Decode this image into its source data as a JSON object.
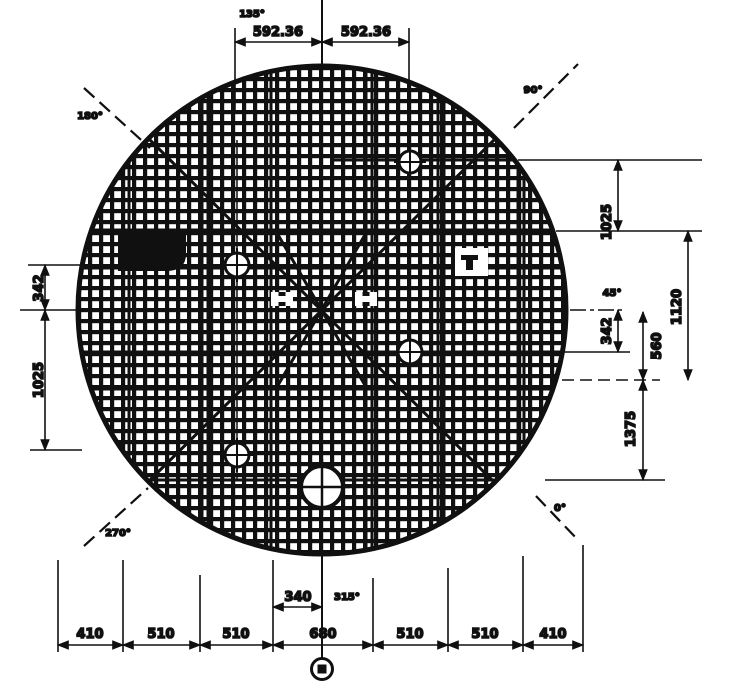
{
  "drawing": {
    "colors": {
      "ink": "#101010",
      "paper": "#ffffff"
    },
    "top": {
      "angle": "135°",
      "dim_left": "592.36",
      "dim_right": "592.36"
    },
    "corners": {
      "top_left": "180°",
      "top_right": "90°",
      "bottom_left": "270°",
      "bottom_right": "0°"
    },
    "left": {
      "dim_upper": "342",
      "dim_lower": "1025"
    },
    "right": {
      "angle": "45°",
      "dim_a": "1025",
      "dim_b": "1120",
      "dim_c": "342",
      "dim_d": "560",
      "dim_e": "1375"
    },
    "bottom": {
      "angle": "315°",
      "dim_offset": "340",
      "dims": [
        "410",
        "510",
        "510",
        "680",
        "510",
        "510",
        "410"
      ]
    }
  }
}
